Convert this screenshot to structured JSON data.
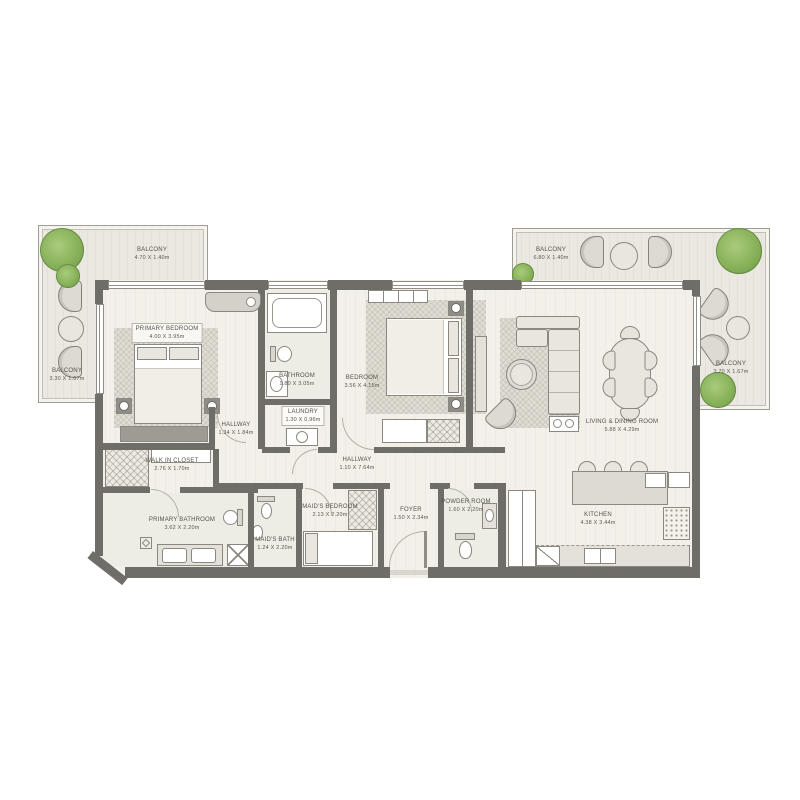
{
  "rooms": {
    "primary_bedroom": {
      "name": "PRIMARY BEDROOM",
      "dims": "4.00 X 3.95m"
    },
    "hallway_primary": {
      "name": "HALLWAY",
      "dims": "1.34 X 1.84m"
    },
    "walk_in_closet": {
      "name": "WALK IN CLOSET",
      "dims": "2.76 X 1.70m"
    },
    "primary_bathroom": {
      "name": "PRIMARY BATHROOM",
      "dims": "3.62 X 2.20m"
    },
    "bathroom": {
      "name": "BATHROOM",
      "dims": "1.80 X 3.05m"
    },
    "laundry": {
      "name": "LAUNDRY",
      "dims": "1.30 X 0.96m"
    },
    "bedroom": {
      "name": "BEDROOM",
      "dims": "3.56 X 4.15m"
    },
    "hallway_main": {
      "name": "HALLWAY",
      "dims": "1.10 X 7.64m"
    },
    "maids_bedroom": {
      "name": "MAID'S BEDROOM",
      "dims": "2.13 X 2.20m"
    },
    "maids_bath": {
      "name": "MAID'S BATH",
      "dims": "1.24 X 2.20m"
    },
    "foyer": {
      "name": "FOYER",
      "dims": "1.50 X 2.34m"
    },
    "powder_room": {
      "name": "POWDER ROOM",
      "dims": "1.60 X 2.20m"
    },
    "living_dining": {
      "name": "LIVING & DINING ROOM",
      "dims": "5.88 X 4.29m"
    },
    "kitchen": {
      "name": "KITCHEN",
      "dims": "4.38 X 3.44m"
    },
    "balcony_left_top": {
      "name": "BALCONY",
      "dims": "4.70 X 1.40m"
    },
    "balcony_left_side": {
      "name": "BALCONY",
      "dims": "3.30 X 1.67m"
    },
    "balcony_right_top": {
      "name": "BALCONY",
      "dims": "6.80 X 1.40m"
    },
    "balcony_right_side": {
      "name": "BALCONY",
      "dims": "3.70 X 1.67m"
    }
  },
  "colors": {
    "wall": "#6e6d68",
    "floor": "#f2f0e9",
    "balcony_floor": "#eae8e0",
    "furniture_fill": "#e8e6de",
    "outline": "#8a8880",
    "tree_green": "#8ab45c",
    "label_text": "#56524b"
  }
}
